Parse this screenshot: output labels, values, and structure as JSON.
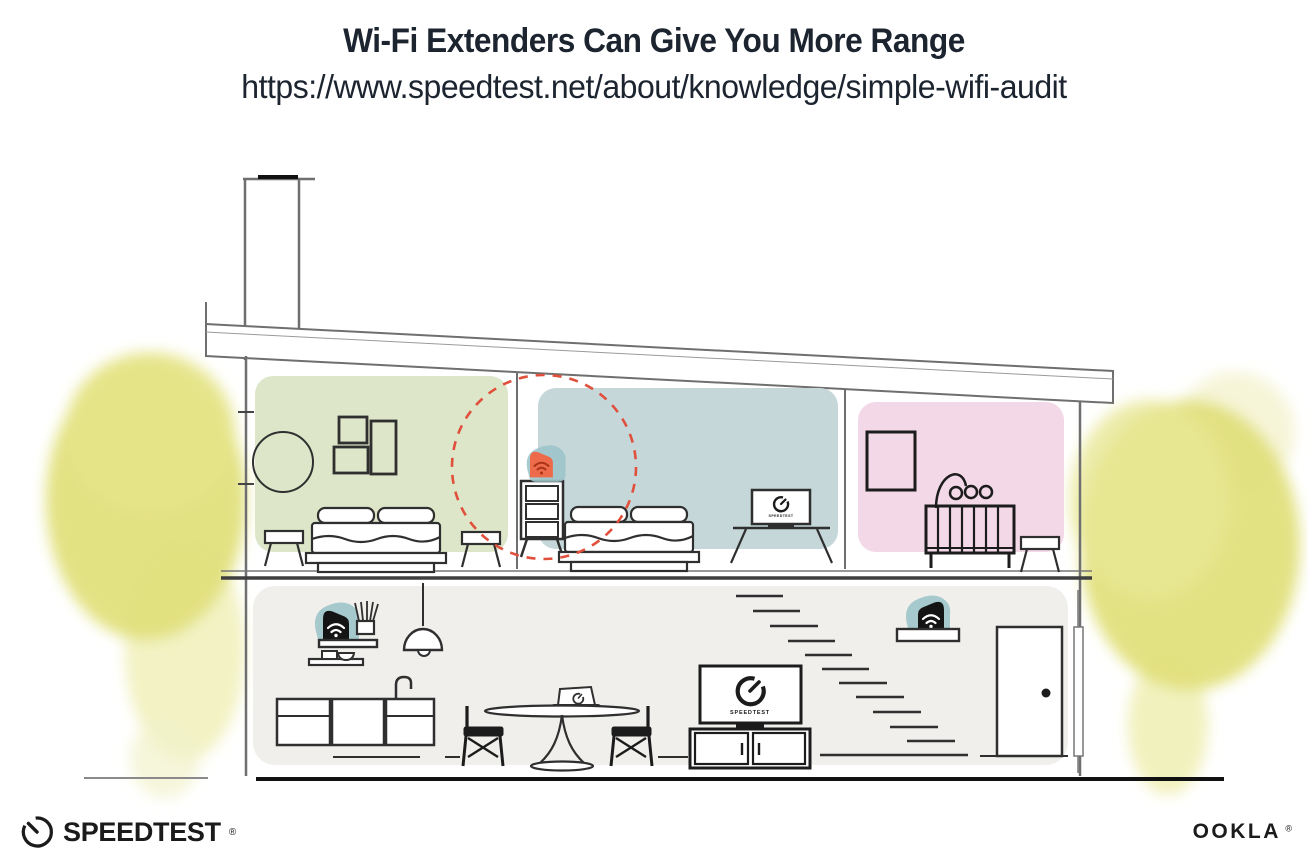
{
  "header": {
    "title": "Wi-Fi Extenders Can Give You More Range",
    "url": "https://www.speedtest.net/about/knowledge/simple-wifi-audit"
  },
  "illustration": {
    "tv_upper_label": "SPEEDTEST",
    "tv_lower_label": "SPEEDTEST",
    "icons": {
      "wifi_extender_highlighted": "orange fin shape with wifi waves on teal blob",
      "wifi_router_black": "black fin shape with white wifi waves on teal blob",
      "speedtest_gauge": "open circle gauge with needle",
      "range_indicator": "red dashed circle"
    },
    "colors": {
      "ink": "#1c2430",
      "green_room": "#dde6c9",
      "blue_room": "#c5d7d9",
      "pink_room": "#f3d8e8",
      "lower_floor": "#f0efec",
      "teal_accent": "#9cc4c9",
      "orange_accent": "#ed6a4a",
      "wifi_dark_red": "#a93317",
      "range_red": "#e0503c",
      "tree_yellow": "#e1e07c",
      "line_dark": "#2f2f2f",
      "wall_gray": "#6f6f6f"
    }
  },
  "footer": {
    "speedtest_wordmark": "SPEEDTEST",
    "speedtest_reg": "®",
    "ookla_wordmark": "OOKLA",
    "ookla_reg": "®"
  }
}
